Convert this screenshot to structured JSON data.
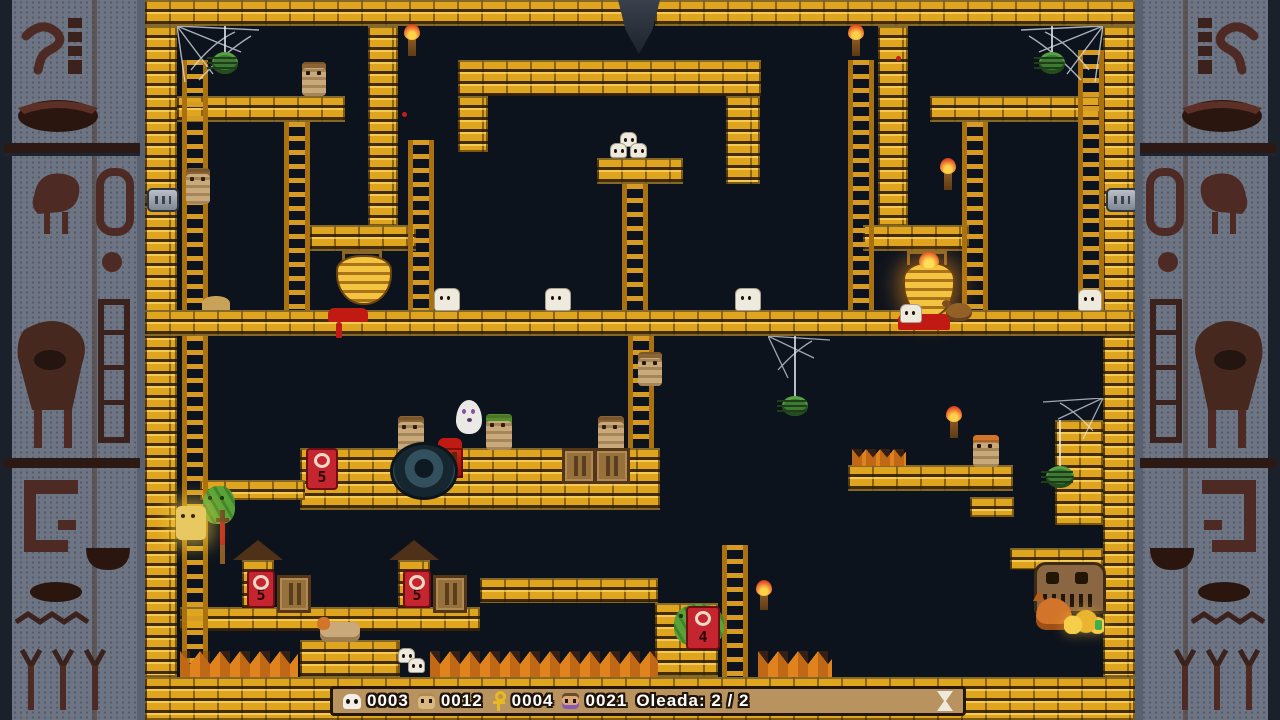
{
  "hud": {
    "counters": [
      {
        "icon": "skull-icon",
        "value": "0003"
      },
      {
        "icon": "mummy-icon",
        "value": "0012"
      },
      {
        "icon": "ankh-icon",
        "value": "0004"
      },
      {
        "icon": "villager-icon",
        "value": "0021"
      }
    ],
    "wave_label": "Oleada: 2 / 2",
    "timer_icon": "hourglass-icon"
  },
  "locks": {
    "digits": [
      "5",
      "5",
      "5",
      "4"
    ]
  },
  "colors": {
    "background": "#0d131d",
    "brick_gold": "#e0a51f",
    "brick_highlight": "#f7d454",
    "border_stone": "#6d7585",
    "hieroglyph_red": "#4e2a24",
    "hud_bar": "#b9935f",
    "lock_red": "#c5252f",
    "spike_orange": "#e0831f",
    "blood_red": "#c01a12",
    "spider_green": "#3c7a33",
    "mummy_tan": "#c9a87a"
  }
}
